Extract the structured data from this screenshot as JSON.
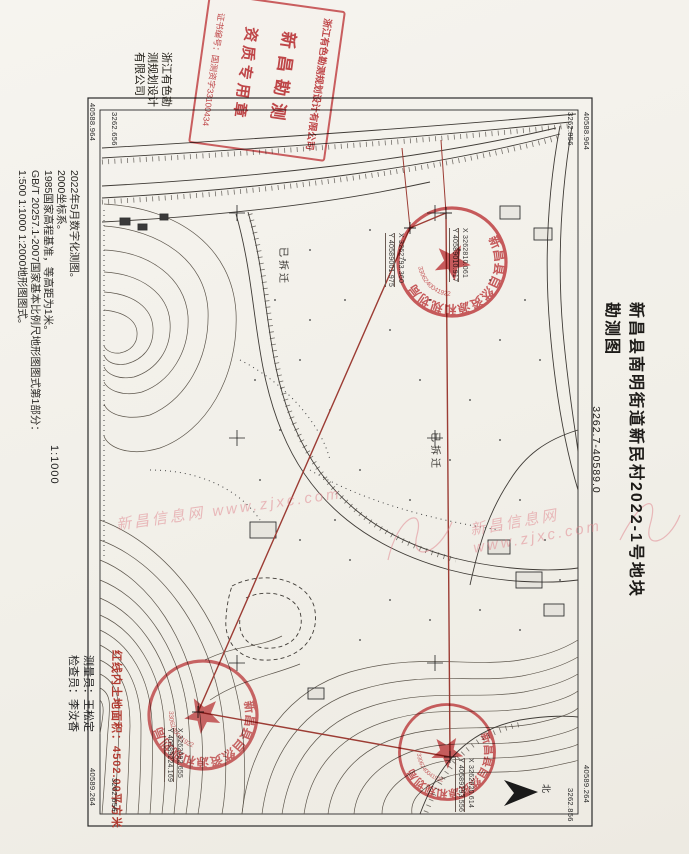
{
  "sheet": {
    "title": "新昌县南明街道新民村2022-1号地块勘测图",
    "subtitle": "3262.7-40589.0",
    "company_margin": "浙江有色勘测规划设计有限公司",
    "scale": "1:1000",
    "notes": [
      "2022年5月数字化测图。",
      "2000坐标系。",
      "1985国家高程基准，等高距为1米。",
      "GB/T 20257.1-2007国家基本比例尺地形图图式第1部分：",
      "1:500 1:1000 1:2000地形图图式。"
    ],
    "surveyor": "测量员：王松定",
    "checker": "检查员：李汝香",
    "area_note": "红线内土地面积：4502.00平方米",
    "north_label": "北"
  },
  "frame_labels": {
    "tl_outer": "40588.964",
    "tl_inner": "3262.656",
    "tr_inner": "3262.856",
    "tr_outer": "40588.964",
    "bl_outer": "40589.264",
    "bl_inner": "3262.656",
    "br_outer": "40589.264",
    "br_inner": "3262.856"
  },
  "map_labels": {
    "demolished_1": "已拆迁",
    "demolished_2": "已拆迁",
    "corner_b_x": "X 3262810.061",
    "corner_b_y": "Y 40589010.917",
    "corner_a_x": "X 3262793.360",
    "corner_a_y": "Y 40589001.975",
    "corner_d_x": "X 3262692.655",
    "corner_d_y": "Y 40589224.169",
    "corner_c_x": "X 3262620.614",
    "corner_c_y": "Y 40589293.556"
  },
  "stamps": {
    "rect_line1": "浙江有色勘测规划设计有限公司",
    "rect_line2": "新昌勘测",
    "rect_line3": "资质专用章",
    "rect_line4": "证书编号：国测资字33100434",
    "round_text": "新昌县自然资源和规划局",
    "round_serial": "3306240041922",
    "accent_color": "#c5373b",
    "parcel_color": "#9c3c34"
  },
  "watermark": {
    "text": "新昌信息网 www.zjxc.com"
  }
}
